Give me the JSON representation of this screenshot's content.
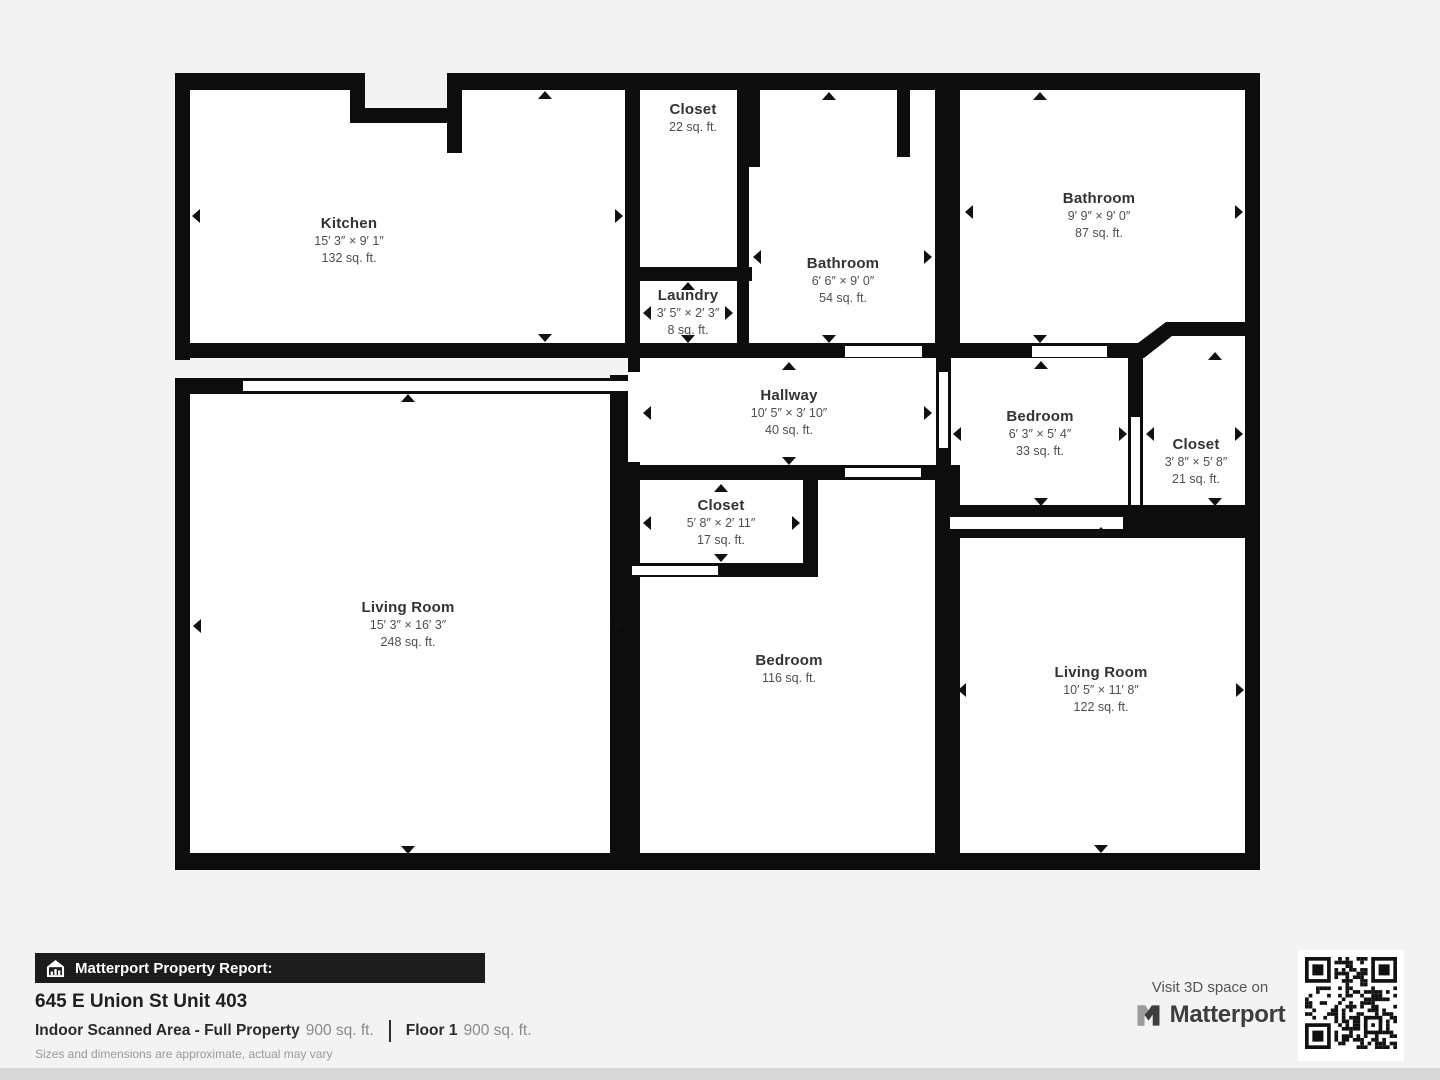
{
  "plan": {
    "rooms": [
      {
        "id": "kitchen",
        "name": "Kitchen",
        "dimensions": "15′ 3″ × 9′ 1″",
        "area": "132 sq. ft."
      },
      {
        "id": "closet-top",
        "name": "Closet",
        "dimensions": "",
        "area": "22 sq. ft."
      },
      {
        "id": "bathroom-small",
        "name": "Bathroom",
        "dimensions": "6′ 6″ × 9′ 0″",
        "area": "54 sq. ft."
      },
      {
        "id": "bathroom-large",
        "name": "Bathroom",
        "dimensions": "9′ 9″ × 9′ 0″",
        "area": "87 sq. ft."
      },
      {
        "id": "laundry",
        "name": "Laundry",
        "dimensions": "3′ 5″ × 2′ 3″",
        "area": "8 sq. ft."
      },
      {
        "id": "hallway",
        "name": "Hallway",
        "dimensions": "10′ 5″ × 3′ 10″",
        "area": "40 sq. ft."
      },
      {
        "id": "bedroom-small",
        "name": "Bedroom",
        "dimensions": "6′ 3″ × 5′ 4″",
        "area": "33 sq. ft."
      },
      {
        "id": "closet-right",
        "name": "Closet",
        "dimensions": "3′ 8″ × 5′ 8″",
        "area": "21 sq. ft."
      },
      {
        "id": "living-room-main",
        "name": "Living Room",
        "dimensions": "15′ 3″ × 16′ 3″",
        "area": "248 sq. ft."
      },
      {
        "id": "closet-middle",
        "name": "Closet",
        "dimensions": "5′ 8″ × 2′ 11″",
        "area": "17 sq. ft."
      },
      {
        "id": "bedroom-main",
        "name": "Bedroom",
        "dimensions": "",
        "area": "116 sq. ft."
      },
      {
        "id": "living-room-right",
        "name": "Living Room",
        "dimensions": "10′ 5″ × 11′ 8″",
        "area": "122 sq. ft."
      }
    ]
  },
  "footer": {
    "report_label": "Matterport Property Report:",
    "address": "645 E Union St Unit 403",
    "scanned_area_label": "Indoor Scanned Area - Full Property",
    "scanned_area_value": "900 sq. ft.",
    "floor_label": "Floor 1",
    "floor_value": "900 sq. ft.",
    "disclaimer": "Sizes and dimensions are approximate, actual may vary",
    "cta_text": "Visit 3D space on",
    "brand": "Matterport"
  },
  "colors": {
    "wall": "#0d0d0d",
    "room": "#ffffff",
    "background": "#f3f3f3",
    "banner": "#1c1c1c",
    "text_dark": "#1f1f1f",
    "text_gray": "#8a8a8a"
  }
}
